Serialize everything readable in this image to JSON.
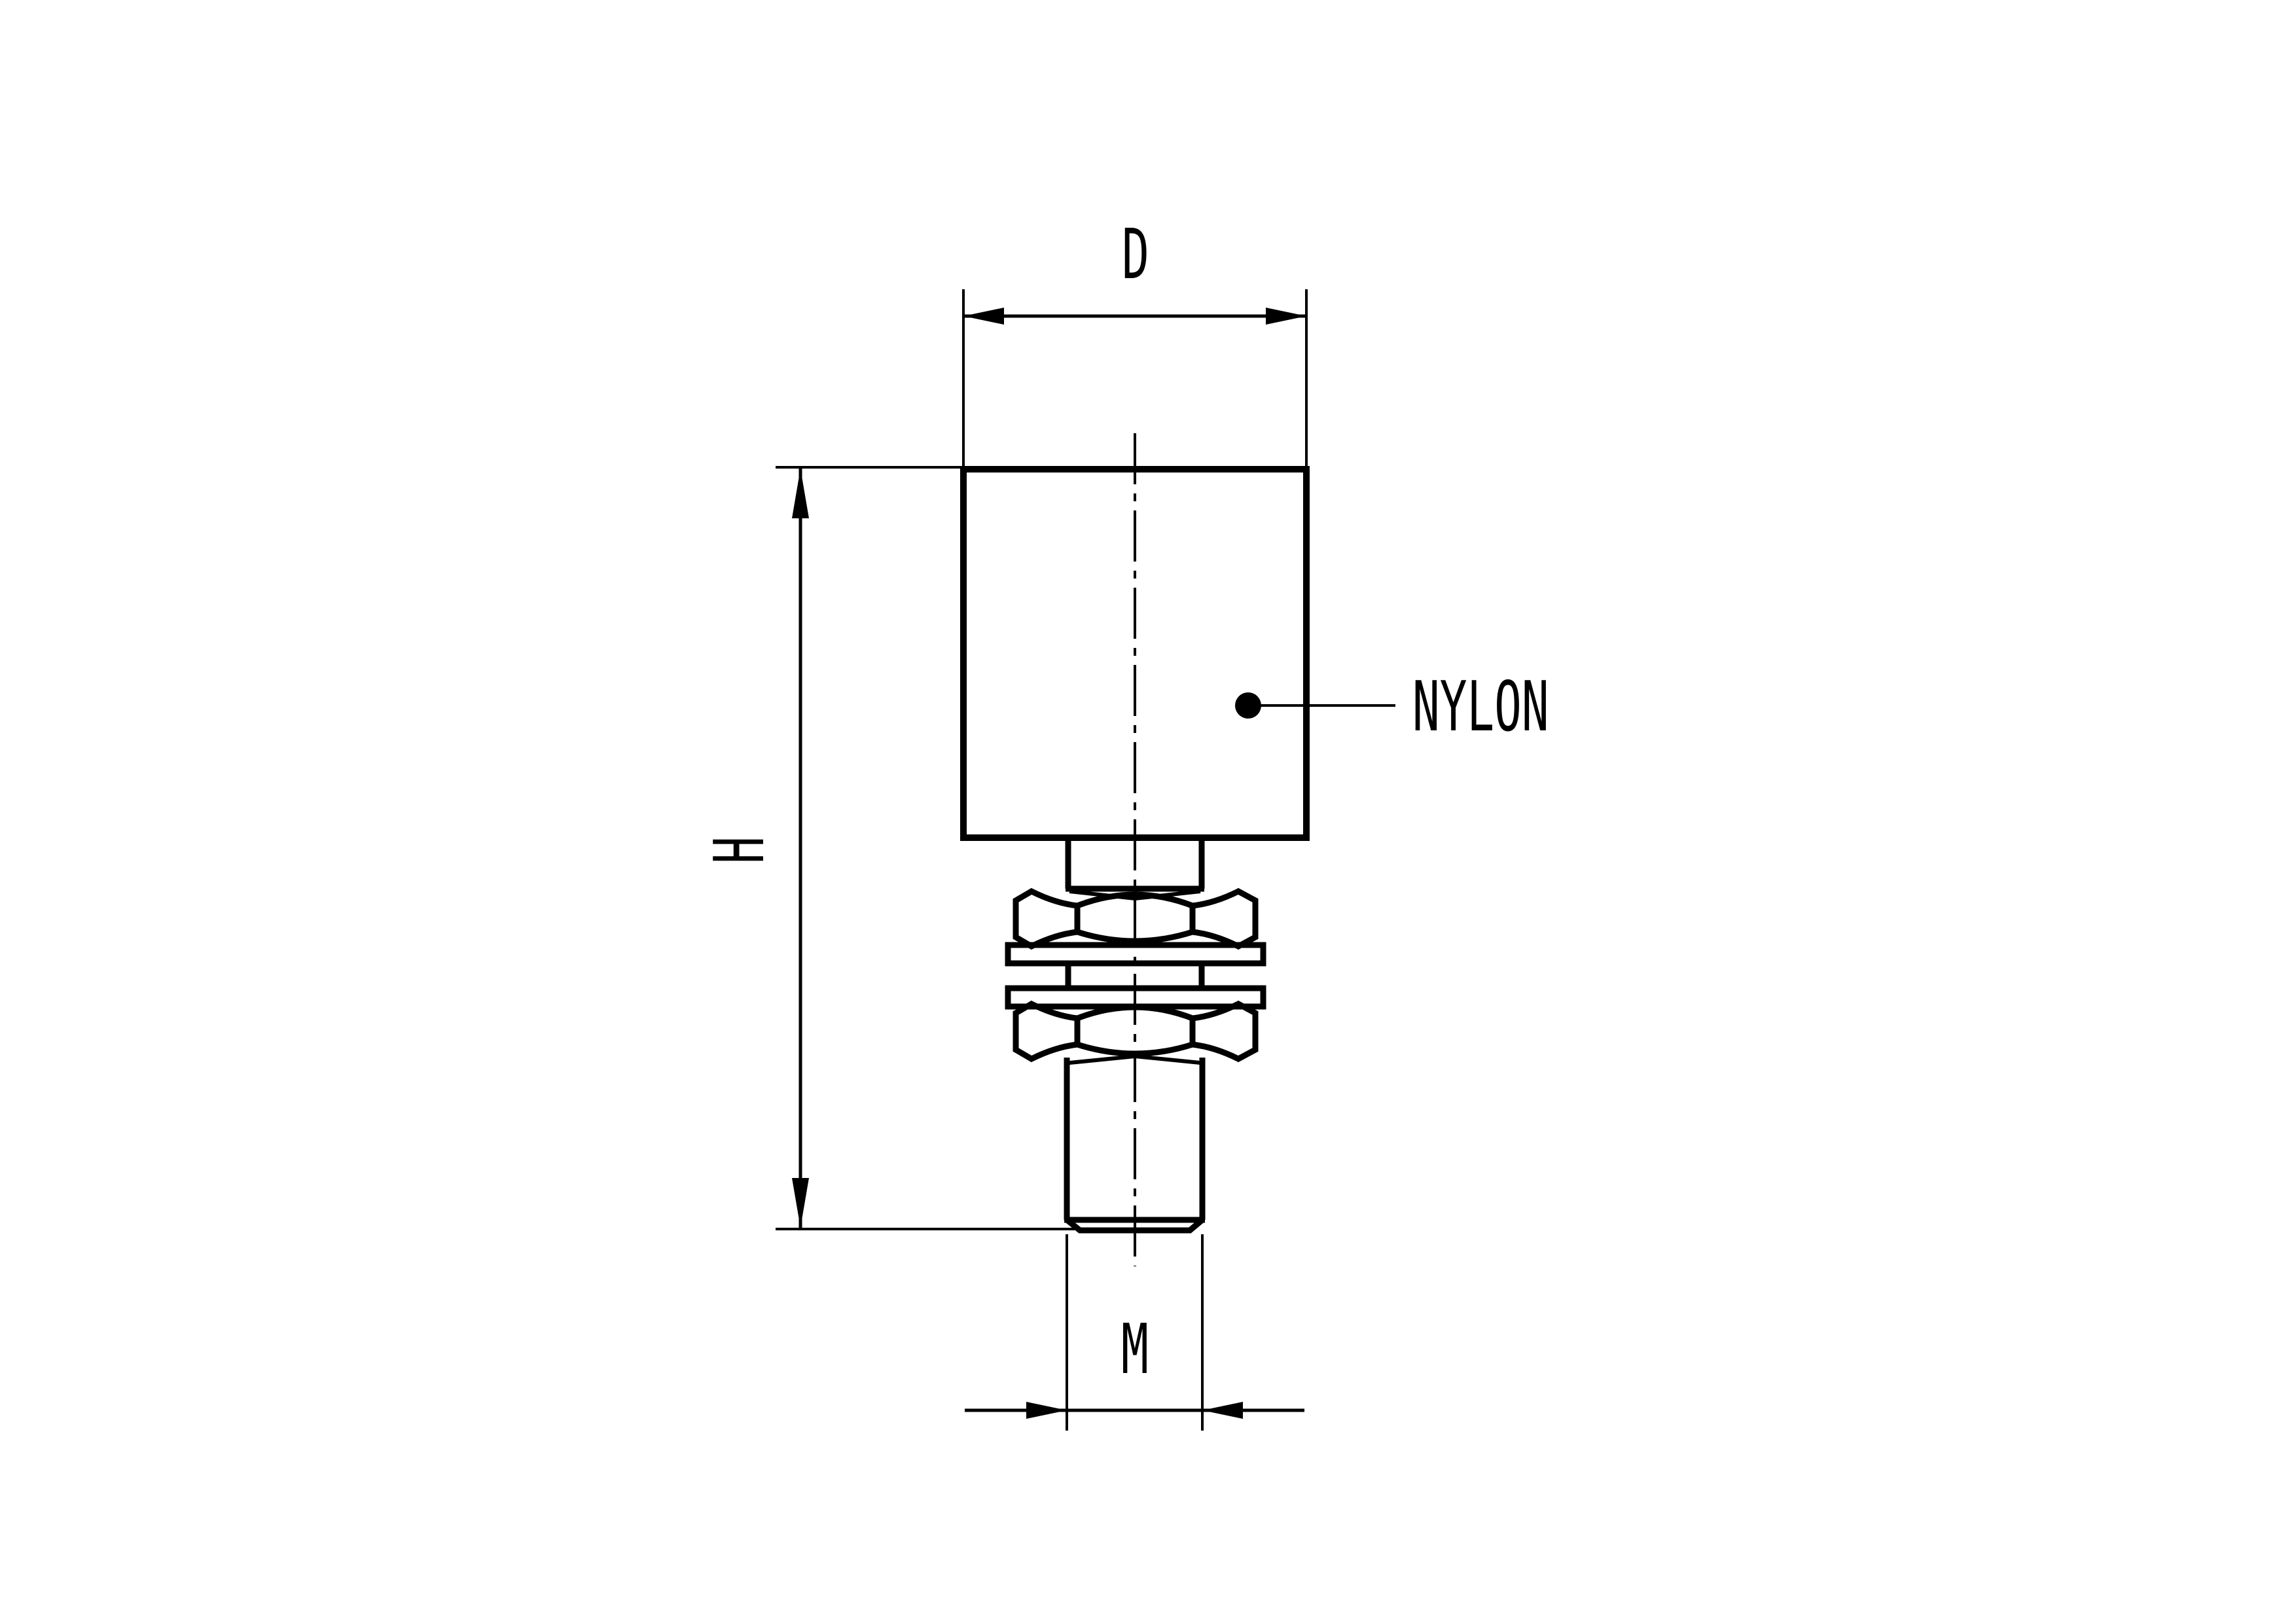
{
  "drawing": {
    "labels": {
      "diameter_label": "D",
      "height_label": "H",
      "thread_label": "M",
      "material_label": "NYLON"
    },
    "colors": {
      "ink": "#000000",
      "paper": "#ffffff"
    }
  }
}
